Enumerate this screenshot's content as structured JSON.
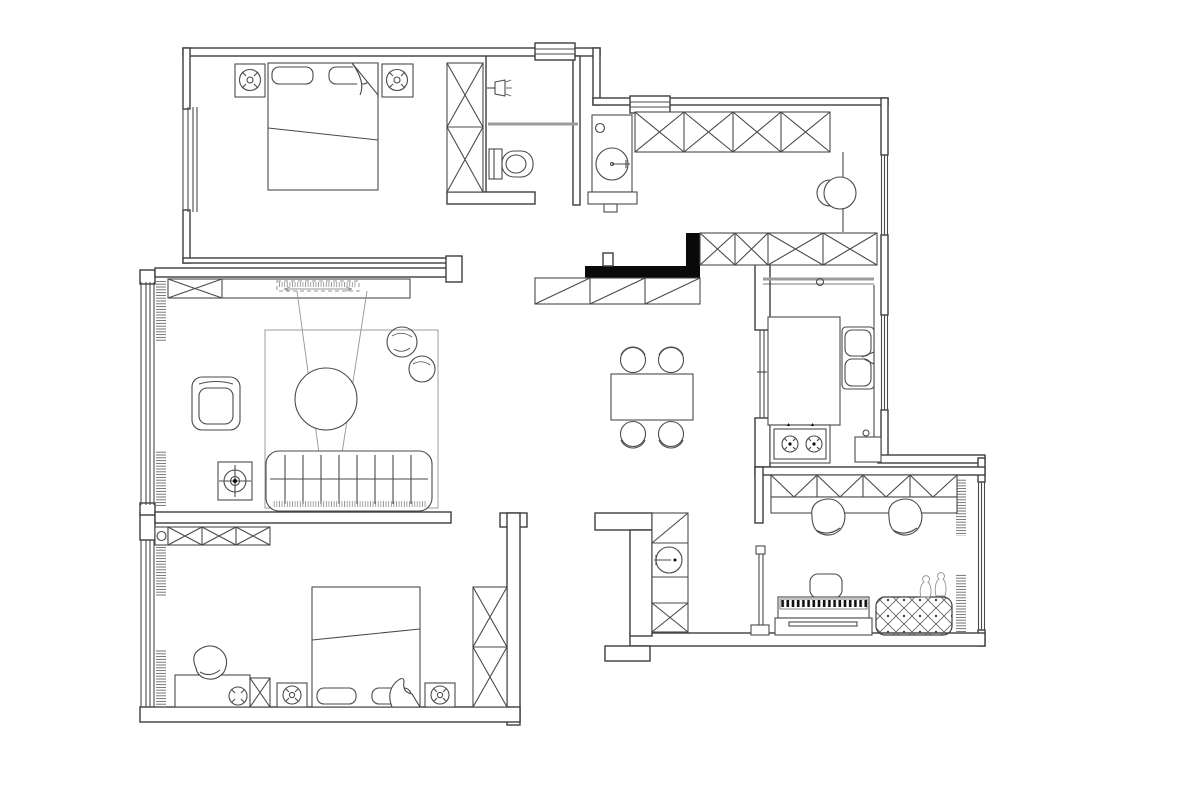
{
  "document": {
    "type": "architectural-floor-plan",
    "title": "Residential apartment floor plan (CAD line drawing)",
    "visible_text_labels": [],
    "style": "black line-work on white, hollow walls, X-hatched cabinetry, solid black feature wall"
  },
  "colors": {
    "background": "#ffffff",
    "wall_line": "#3d3d3d",
    "furniture_line": "#4a4a4a",
    "light_line": "#949494",
    "solid_wall_fill": "#0a0a0a",
    "partition_gray": "#9c9c9c"
  },
  "rooms": [
    {
      "id": "master-bedroom",
      "position": "top-left",
      "furniture": [
        "double-bed",
        "pillows x2",
        "blanket-fold",
        "nightstand-with-lamp x2",
        "x-hatched-wardrobe",
        "left-window"
      ]
    },
    {
      "id": "bathroom",
      "position": "top-center",
      "furniture": [
        "shower-head",
        "glass-partition-gray",
        "toilet",
        "vent-flue x2"
      ]
    },
    {
      "id": "hallway",
      "position": "center",
      "furniture": [
        "washbasin-cabinet-round",
        "x-hatched-storage-row",
        "chair-round",
        "partition-line"
      ]
    },
    {
      "id": "living-room",
      "position": "middle-left",
      "furniture": [
        "projector-screen-dashed",
        "projection-cone-lines",
        "x-hatched-tv-cabinet",
        "armchair",
        "round-coffee-table",
        "plant x2",
        "area-rug",
        "grid-sofa",
        "side-table-with-crosshair-lamp",
        "left-window-with-curtains"
      ]
    },
    {
      "id": "dining-area",
      "position": "center",
      "furniture": [
        "dining-table",
        "dining-chair x4",
        "hatched-shoe-cabinet",
        "solid-black-feature-wall"
      ]
    },
    {
      "id": "kitchen",
      "position": "right",
      "furniture": [
        "counter-island",
        "double-bowl-sink",
        "gas-stove-2-burner",
        "x-hatched-upper-cabinets",
        "sliding-door",
        "right-windows",
        "corner-unit"
      ]
    },
    {
      "id": "second-bedroom",
      "position": "bottom-left",
      "furniture": [
        "double-bed",
        "pillows x2",
        "desk",
        "desk-chair",
        "desk-lamp",
        "nightstand-with-lamp x2",
        "small-x-cabinet",
        "x-hatched-wardrobe",
        "x-hatched-top-cabinet",
        "left-window-with-curtains"
      ]
    },
    {
      "id": "study-piano-room",
      "position": "bottom-right",
      "furniture": [
        "hatched-wall-desk",
        "desk-chair x2",
        "upright-piano",
        "diamond-tufted-bench",
        "figurines x2",
        "floor-lamp",
        "stool",
        "right-window-with-curtains"
      ]
    },
    {
      "id": "utility-vanity-nook",
      "position": "bottom-center",
      "furniture": [
        "tall-cabinet-column",
        "round-basin-with-tap",
        "x-hatched-base-cell",
        "entry-step"
      ]
    }
  ],
  "symbols_legend": [
    {
      "name": "x-box",
      "meaning": "wardrobe / cabinet"
    },
    {
      "name": "diagonal-hatch-row",
      "meaning": "low cabinet / desk"
    },
    {
      "name": "circle-with-spokes-in-square",
      "meaning": "nightstand with lamp"
    },
    {
      "name": "crosshair-circles",
      "meaning": "lamp on side table"
    },
    {
      "name": "triple-parallel-lines",
      "meaning": "window glazing"
    },
    {
      "name": "fine-horizontal-tick-strip",
      "meaning": "curtain"
    },
    {
      "name": "solid-black",
      "meaning": "new masonry feature wall"
    }
  ]
}
